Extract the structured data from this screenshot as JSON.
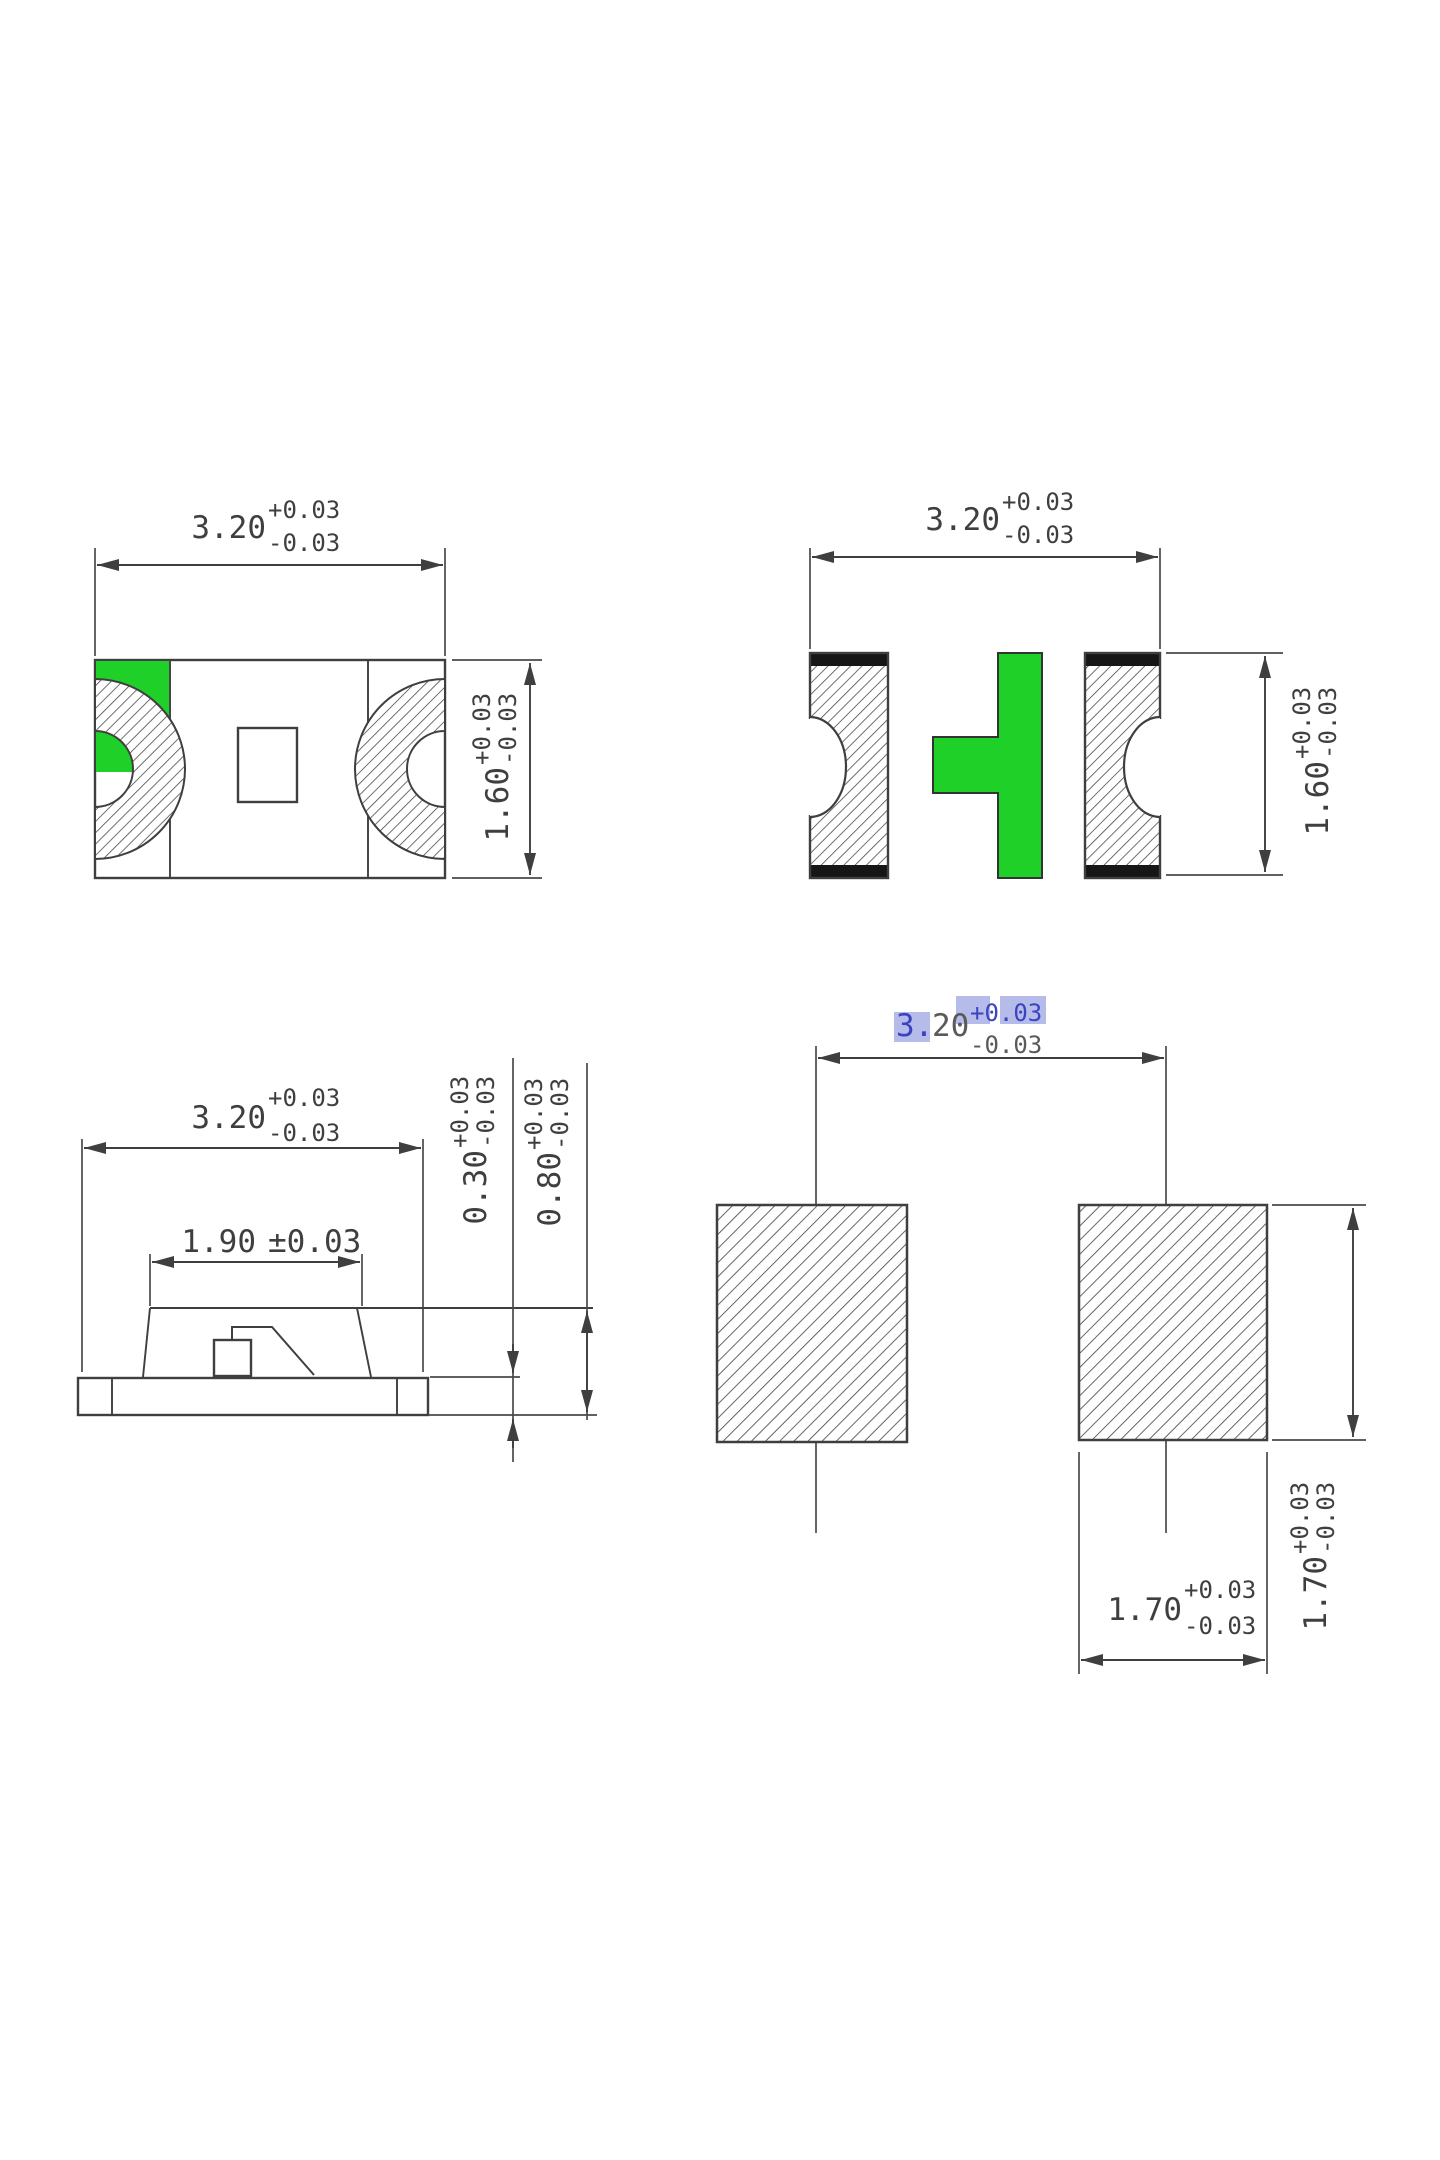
{
  "drawing": {
    "kind": "smd-led-package-dimension-drawing",
    "units_note": "",
    "colors": {
      "line": "#3f3f3f",
      "polarity_green": "#1fd028",
      "terminal_cap_black": "#161616",
      "highlight_bg": "#b5bce9",
      "highlight_text": "#3c42c0"
    }
  },
  "views": {
    "top_view": {
      "dim_width": {
        "value": "3.20",
        "plus": "+0.03",
        "minus": "-0.03"
      },
      "dim_height": {
        "value": "1.60",
        "plus": "+0.03",
        "minus": "-0.03"
      }
    },
    "bottom_view": {
      "dim_width": {
        "value": "3.20",
        "plus": "+0.03",
        "minus": "-0.03"
      },
      "dim_height": {
        "value": "1.60",
        "plus": "+0.03",
        "minus": "-0.03"
      }
    },
    "side_view": {
      "dim_width": {
        "value": "3.20",
        "plus": "+0.03",
        "minus": "-0.03"
      },
      "dim_top_width": {
        "value": "1.90",
        "tol": "±0.03"
      },
      "dim_base": {
        "value": "0.30",
        "plus": "+0.03",
        "minus": "-0.03"
      },
      "dim_height": {
        "value": "0.80",
        "plus": "+0.03",
        "minus": "-0.03"
      }
    },
    "pad_layout": {
      "dim_span": {
        "value_hl": "3.",
        "value_rest": "20",
        "plus": "+0.03",
        "minus": "-0.03"
      },
      "dim_pad_width": {
        "value": "1.70",
        "plus": "+0.03",
        "minus": "-0.03"
      },
      "dim_pad_height": {
        "value": "1.70",
        "plus": "+0.03",
        "minus": "-0.03"
      }
    }
  }
}
